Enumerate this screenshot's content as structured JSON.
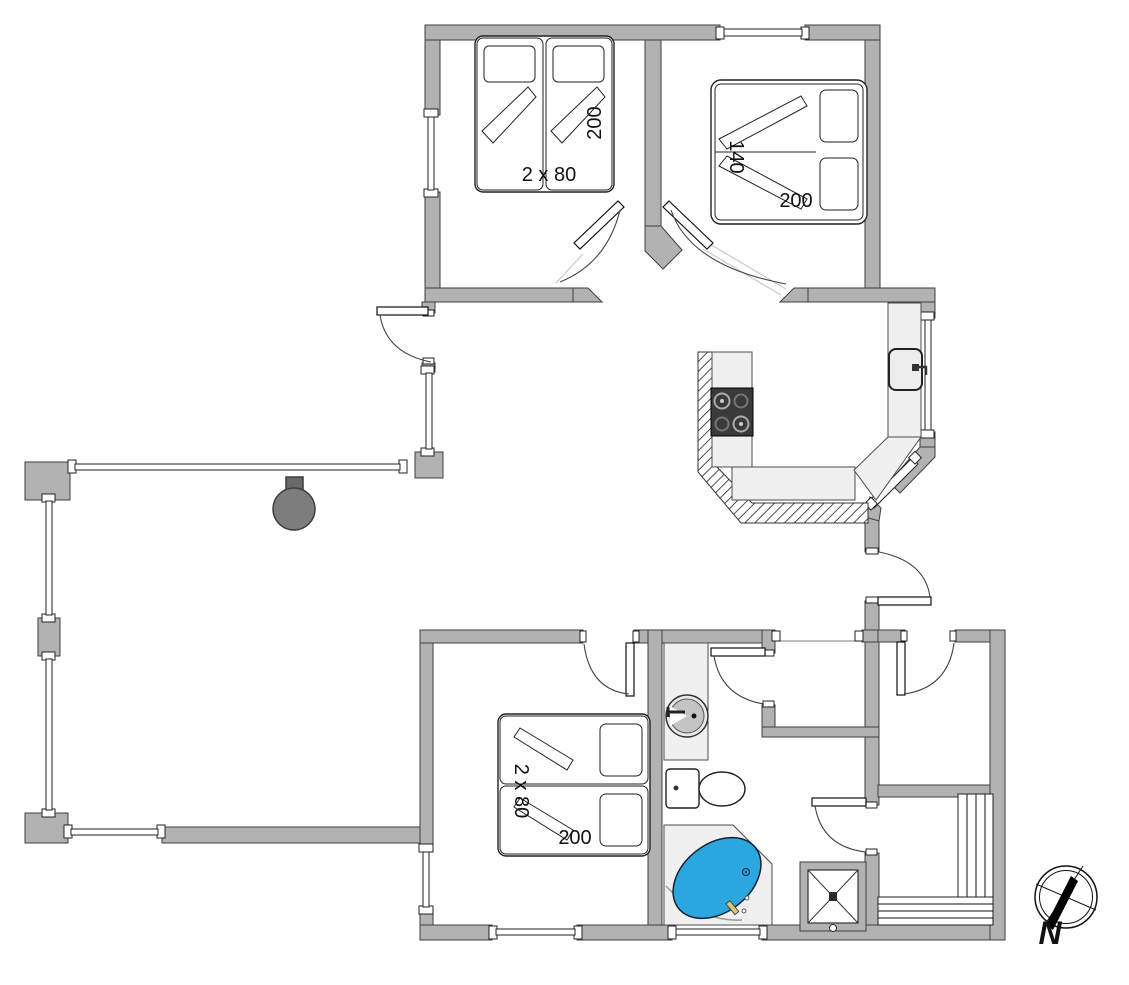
{
  "colors": {
    "background": "#ffffff",
    "wall": "#b2b2b2",
    "wall_outline": "#3f3f3f",
    "counter": "#f0f0f0",
    "stove_top": "#3a3a3a",
    "bathtub_blue": "#2ba6de",
    "wood_stove_gray": "#7d7d7d"
  },
  "labels": {
    "bedroom_nw": {
      "bed_width": "2 x 80",
      "bed_length": "200"
    },
    "bedroom_ne": {
      "bed_width": "140",
      "bed_length": "200"
    },
    "bedroom_sw": {
      "bed_width": "2 x 80",
      "bed_length": "200"
    },
    "compass_north": "N"
  },
  "fixtures": [
    "twin-beds-nw",
    "double-bed-ne",
    "twin-beds-sw",
    "kitchen-stove",
    "kitchen-sink",
    "kitchen-counter",
    "hatched-half-wall",
    "bathroom-sink",
    "toilet",
    "corner-bathtub",
    "shower",
    "sauna-benches",
    "wood-burning-stove",
    "compass-rose"
  ]
}
